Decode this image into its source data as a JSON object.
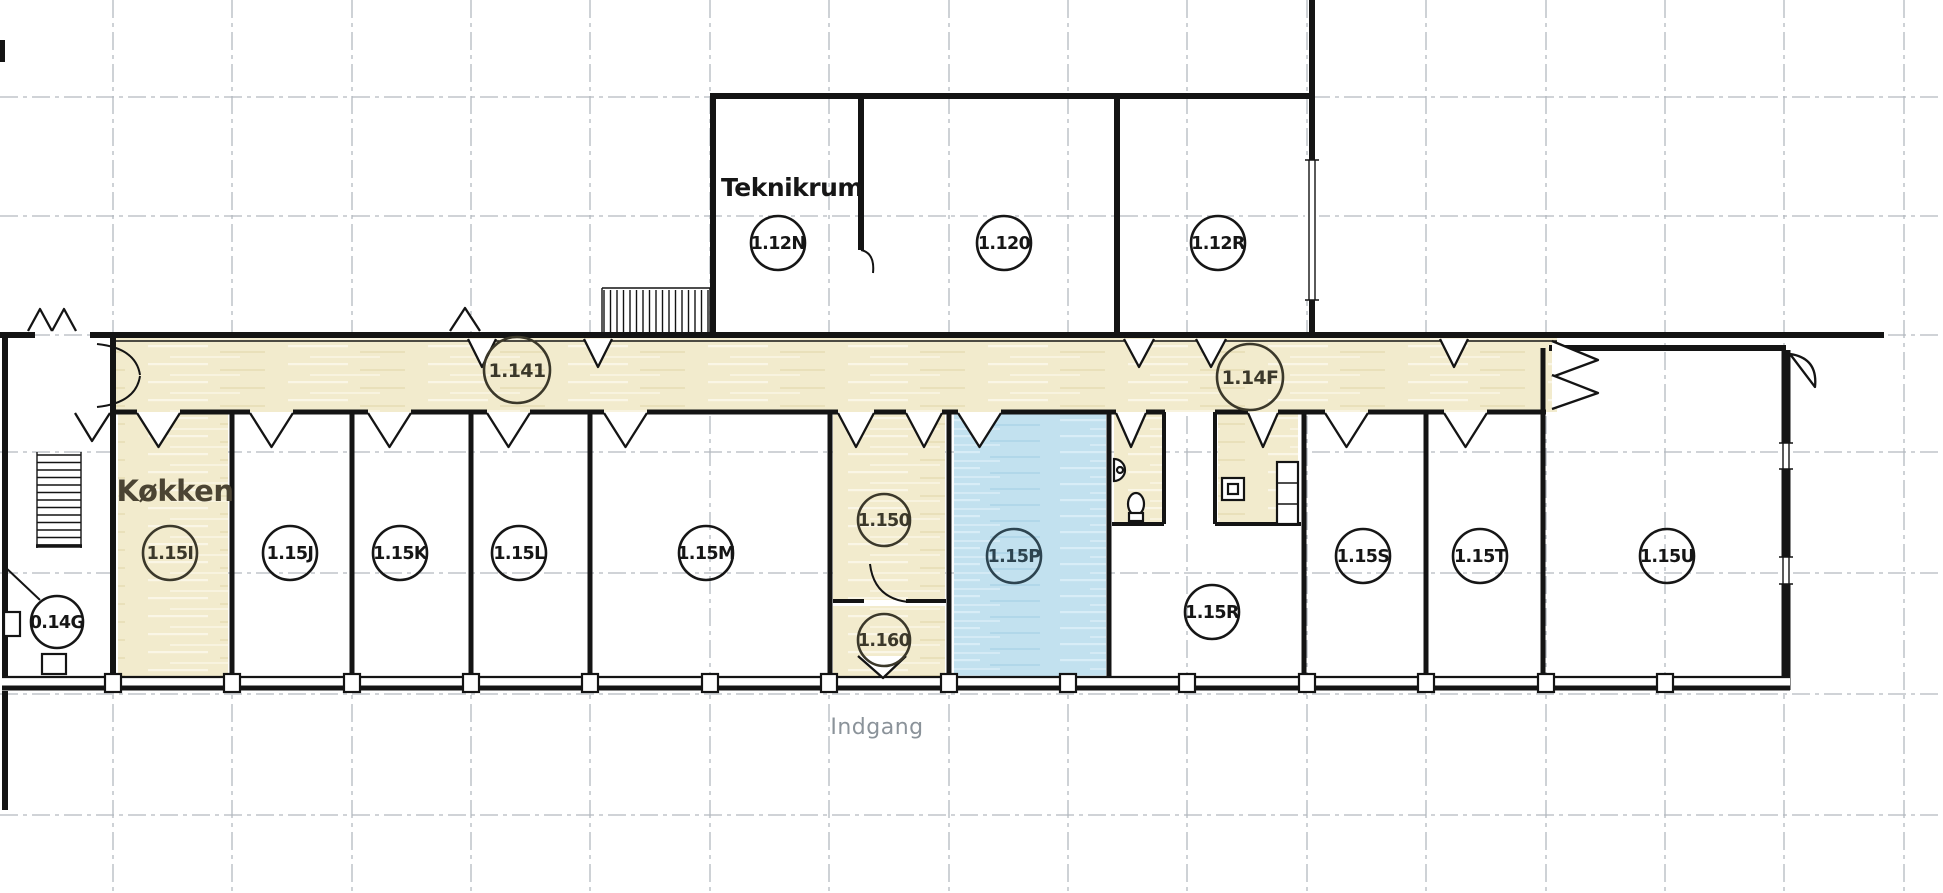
{
  "plan": {
    "labels": {
      "teknikrum": "Teknikrum",
      "kokken": "Køkken",
      "indgang": "Indgang"
    },
    "rooms": {
      "r12n": "1.12N",
      "r120": "1.120",
      "r12r": "1.12R",
      "c141": "1.141",
      "c14f": "1.14F",
      "r014g": "0.14G",
      "r15i": "1.15I",
      "r15j": "1.15J",
      "r15k": "1.15K",
      "r15l": "1.15L",
      "r15m": "1.15M",
      "r150": "1.150",
      "r160": "1.160",
      "r15p": "1.15P",
      "r15r": "1.15R",
      "r15s": "1.15S",
      "r15t": "1.15T",
      "r15u": "1.15U"
    },
    "highlighted_room": "1.15P",
    "colors": {
      "corridor_fill": "#f2ebcd",
      "highlight_fill": "#c2e1ef",
      "wall": "#141414",
      "grid": "#b3b9bf",
      "entrance_text": "#8b939a",
      "kokken_text": "#4b4433"
    }
  }
}
